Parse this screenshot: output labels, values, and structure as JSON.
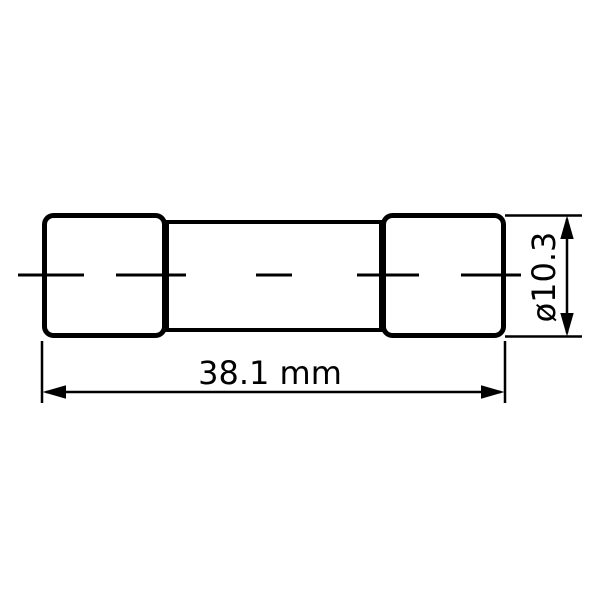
{
  "drawing": {
    "kind": "technical-dimension-drawing",
    "subject": "cylindrical cartridge fuse, side view",
    "labels": {
      "length": "38.1 mm",
      "diameter": "ø10.3"
    },
    "colors": {
      "line": "#000000",
      "background": "#ffffff"
    }
  }
}
